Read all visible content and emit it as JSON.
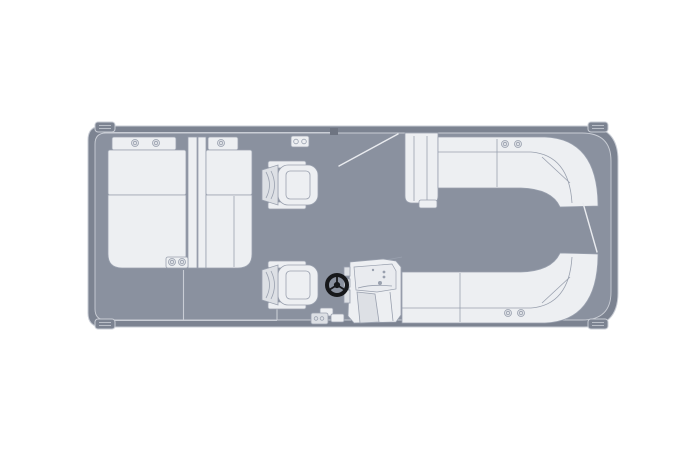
{
  "diagram": {
    "kind": "pontoon-boat-floorplan-top-view",
    "orientation": "bow-right-stern-left",
    "components": [
      "hull",
      "deck",
      "rub-rail",
      "cleat-stern-port",
      "cleat-stern-starboard",
      "cleat-bow-port",
      "cleat-bow-starboard",
      "stern-lounger-left",
      "stern-lounger-right",
      "lounger-headrests",
      "lounger-cupholders",
      "center-armrest-cupholders",
      "port-gate",
      "port-gate-swing-line",
      "gate-latch",
      "companion-captain-chair",
      "helm-captain-chair",
      "helm-console",
      "steering-wheel",
      "helm-step",
      "bow-bench-port-corner-seat",
      "bow-bench-port",
      "bow-bench-starboard",
      "bench-cupholders",
      "bow-gate-swing-line",
      "deck-seam",
      "starboard-rail-line",
      "stern-rail-line",
      "transom-fitting"
    ]
  },
  "colors": {
    "background": "#ffffff",
    "hull_band": "#7c8391",
    "deck": "#8a919f",
    "edge_light": "#c9cdd5",
    "edge_bright": "#e9ebef",
    "furniture": "#edeff2",
    "furniture_shade": "#dde0e5",
    "furniture_line": "#99a0ae",
    "cupholder": "#dfe2e7",
    "detail_dark": "#6e7481",
    "wheel": "#17181b"
  }
}
